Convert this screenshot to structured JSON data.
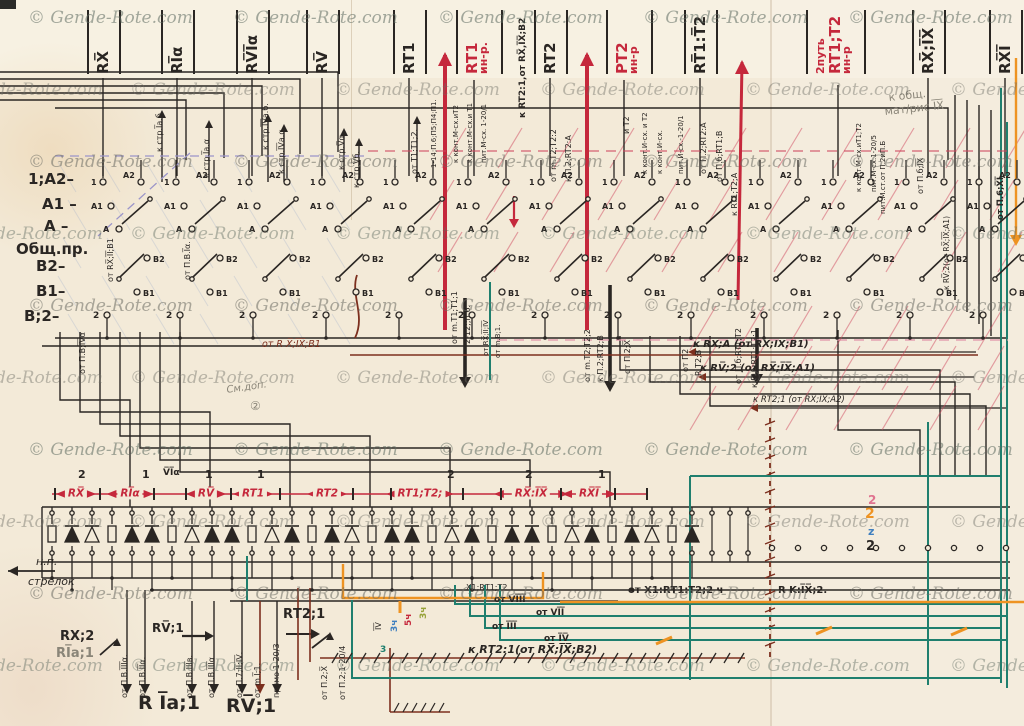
{
  "watermark": {
    "text": "© Gende-Rote.com"
  },
  "colors": {
    "ink": "#2a2623",
    "red": "#c5283c",
    "maroon": "#7c2f1e",
    "teal": "#1f7f6e",
    "orange": "#ee9322",
    "blue": "#3f7fbf",
    "pencil": "#8a8578",
    "pink": "#e0738f",
    "green": "#97a239",
    "lavender": "#9b95c9",
    "paper": "#f3ead8"
  },
  "top_labels": [
    {
      "name": "strip-rx",
      "lines": [
        "RX̅"
      ],
      "main": 0,
      "x": 103,
      "color": "ink"
    },
    {
      "name": "strip-ria",
      "lines": [
        "RI̅α"
      ],
      "main": 0,
      "x": 177,
      "color": "ink"
    },
    {
      "name": "strip-rvia",
      "lines": [
        "RV̅I̅α"
      ],
      "main": 0,
      "x": 252,
      "color": "ink"
    },
    {
      "name": "strip-rv",
      "lines": [
        "RV̅"
      ],
      "main": 0,
      "x": 322,
      "color": "ink"
    },
    {
      "name": "strip-rt1",
      "lines": [
        "RT1"
      ],
      "main": 0,
      "x": 409,
      "color": "ink"
    },
    {
      "name": "strip-rt1-inr",
      "lines": [
        "RT1",
        "ин-р."
      ],
      "main": 0,
      "x": 472,
      "color": "red"
    },
    {
      "name": "strip-rt2",
      "lines": [
        "RT2"
      ],
      "main": 0,
      "x": 550,
      "color": "ink"
    },
    {
      "name": "strip-pt2-inr",
      "lines": [
        "PT2",
        "ин-р"
      ],
      "main": 0,
      "x": 622,
      "color": "red"
    },
    {
      "name": "strip-rt1t2",
      "lines": [
        "RT̅1:T̅2"
      ],
      "main": 0,
      "x": 700,
      "color": "ink"
    },
    {
      "name": "strip-2put",
      "lines": [
        "2путь",
        "RT1;T2",
        "ин-р"
      ],
      "main": 1,
      "x": 822,
      "color": "red"
    },
    {
      "name": "strip-rxix",
      "lines": [
        "RX̅;I̅X̅"
      ],
      "main": 0,
      "x": 928,
      "color": "ink"
    },
    {
      "name": "strip-rxi",
      "lines": [
        "RX̅I̅"
      ],
      "main": 0,
      "x": 1005,
      "color": "ink"
    }
  ],
  "left_labels": [
    {
      "name": "row-1a2",
      "t": "1;A2–",
      "x": 28,
      "y": 172
    },
    {
      "name": "row-a1",
      "t": "A1 –",
      "x": 42,
      "y": 197
    },
    {
      "name": "row-a",
      "t": "A –",
      "x": 44,
      "y": 219
    },
    {
      "name": "row-obsh",
      "t": "Общ.пр.",
      "x": 16,
      "y": 242
    },
    {
      "name": "row-b2",
      "t": "B2–",
      "x": 36,
      "y": 259
    },
    {
      "name": "row-b1",
      "t": "B1–",
      "x": 36,
      "y": 284
    },
    {
      "name": "row-b2b",
      "t": "B;2–",
      "x": 24,
      "y": 309
    }
  ],
  "rail": {
    "labels": [
      {
        "t": "RX̅",
        "x": 76
      },
      {
        "t": "RI̅α",
        "x": 130
      },
      {
        "t": "RV̅",
        "x": 206
      },
      {
        "t": "RT1",
        "x": 253
      },
      {
        "t": "RT2",
        "x": 327
      },
      {
        "t": "RT1;T2;",
        "x": 420
      },
      {
        "t": "RX̅:I̅X̅",
        "x": 531
      },
      {
        "t": "RX̅I̅",
        "x": 589
      }
    ],
    "numbers": [
      {
        "t": "2",
        "x": 78
      },
      {
        "t": "1",
        "x": 142
      },
      {
        "t": "V̅I̅α",
        "x": 163,
        "small": true
      },
      {
        "t": "1",
        "x": 205
      },
      {
        "t": "1",
        "x": 257
      },
      {
        "t": "2",
        "x": 447
      },
      {
        "t": "2",
        "x": 525
      },
      {
        "t": "1",
        "x": 598
      }
    ],
    "ticks": [
      54,
      99,
      153,
      185,
      230,
      279,
      352,
      390,
      462,
      500,
      560,
      614,
      646
    ]
  },
  "contact": {
    "centers": [
      135,
      208,
      281,
      354,
      427,
      500,
      573,
      646,
      719,
      792,
      865,
      938,
      1011
    ],
    "terminals": {
      "t1": "1",
      "a2": "A2",
      "a1": "A1",
      "a": "A",
      "b2": "B2",
      "b1": "B1",
      "t2": "2"
    }
  },
  "diodes": {
    "pattern": [
      "R",
      "F",
      "O",
      "R",
      "F",
      "F",
      "R",
      "O",
      "F",
      "F",
      "R",
      "O",
      "F",
      "R",
      "F",
      "O",
      "R",
      "F",
      "F",
      "R",
      "O",
      "F",
      "R",
      "F",
      "F",
      "R",
      "O",
      "F",
      "R",
      "F",
      "O",
      "R",
      "F"
    ]
  },
  "labels": [
    {
      "n": "wire-k-str-1a-b",
      "t": "к стр.I̅a.б.",
      "x": 156,
      "y": 152,
      "r": -90
    },
    {
      "n": "wire-k-str-1a-a",
      "t": "к стр.I̅a.α",
      "x": 203,
      "y": 178,
      "r": -90
    },
    {
      "n": "wire-k-str-4a-b",
      "t": "к стр.I̅V̅a.б.",
      "x": 262,
      "y": 150,
      "r": -90
    },
    {
      "n": "wire-k-str-4a-a",
      "t": "к стр.I̅V̅a.α.",
      "x": 278,
      "y": 174,
      "r": -90
    },
    {
      "n": "wire-k-str-va",
      "t": "к стр.V̅α.",
      "x": 338,
      "y": 170,
      "r": -90
    },
    {
      "n": "wire-k-str-vb",
      "t": "к стр.V̅б.",
      "x": 353,
      "y": 188,
      "r": -90
    },
    {
      "n": "wire-ot-t1",
      "t": "от Т1;Т1;2.",
      "x": 411,
      "y": 174,
      "r": -90
    },
    {
      "n": "wire-114",
      "t": "1-14;П.6;П5;П4;П1.",
      "x": 431,
      "y": 168,
      "r": -90,
      "s": 7
    },
    {
      "n": "wire-kont-m-t2",
      "t": "к конт.М-сх.иТ2",
      "x": 453,
      "y": 163,
      "r": -90,
      "s": 7
    },
    {
      "n": "wire-kont-m-t1",
      "t": "к конт.М-сх.и Т1",
      "x": 467,
      "y": 163,
      "r": -90,
      "s": 7
    },
    {
      "n": "wire-pit-m",
      "t": "пит.М-сх. 1-20/1",
      "x": 481,
      "y": 163,
      "r": -90,
      "s": 7
    },
    {
      "n": "wire-krt21",
      "t": "к RT2:1,от RX̅,I̅X̅;B2",
      "x": 519,
      "y": 118,
      "r": -90,
      "s": 9,
      "b": 1
    },
    {
      "n": "wire-ot-mt2",
      "t": "от m.Т2;Т2:2",
      "x": 550,
      "y": 182,
      "r": -90
    },
    {
      "n": "wire-kp2-rt2a",
      "t": "к П.2;RT2:A",
      "x": 565,
      "y": 182,
      "r": -90
    },
    {
      "n": "wire-it2",
      "t": "и Т2",
      "x": 623,
      "y": 134,
      "r": -90
    },
    {
      "n": "wire-kont-i-t2",
      "t": "к конт.И-сх. и Т2",
      "x": 642,
      "y": 174,
      "r": -90,
      "s": 7
    },
    {
      "n": "wire-kont-i",
      "t": "к конт.И-сх.",
      "x": 657,
      "y": 174,
      "r": -90,
      "s": 7
    },
    {
      "n": "wire-pit-i",
      "t": "пит.И-сх.-1-20/1",
      "x": 678,
      "y": 174,
      "r": -90,
      "s": 7
    },
    {
      "n": "wire-otp2-rt2a",
      "t": "от П.2;RT2:A",
      "x": 700,
      "y": 174,
      "r": -90
    },
    {
      "n": "wire-otpb-rt1b",
      "t": "от П.б;RT1;B",
      "x": 716,
      "y": 182,
      "r": -90
    },
    {
      "n": "wire-krt1t2a",
      "t": "к RT1;Т2;A",
      "x": 731,
      "y": 216,
      "r": -90
    },
    {
      "n": "wire-kont-m-t1t2",
      "t": "к конт.М-сх.иТ1;Т2",
      "x": 856,
      "y": 192,
      "r": -90,
      "s": 7
    },
    {
      "n": "wire-pit-m5",
      "t": "пит.М-сх.1-20/5",
      "x": 871,
      "y": 192,
      "r": -90,
      "s": 7
    },
    {
      "n": "wire-pit-mst",
      "t": "пит.М.ст.от П.2иП.Б",
      "x": 880,
      "y": 214,
      "r": -90,
      "s": 7
    },
    {
      "n": "wire-otpb-ix",
      "t": "от П.б;I̅X̅",
      "x": 917,
      "y": 194,
      "r": -90
    },
    {
      "n": "wire-krv2",
      "t": "к RV̅;2(от RX̅;I̅X̅;A1)",
      "x": 943,
      "y": 290,
      "r": -90,
      "s": 7.5
    },
    {
      "n": "wire-otp6-xi",
      "t": "от П.6;X̅I̅",
      "x": 997,
      "y": 220,
      "r": -90,
      "s": 8.5,
      "b": 1
    },
    {
      "n": "wire-otpv-4a",
      "t": "от П.В;I̅V̅α",
      "x": 79,
      "y": 374,
      "r": -90
    },
    {
      "n": "wire-otrx-b1",
      "t": "от RX̅;I̅I̅;B1",
      "x": 107,
      "y": 282,
      "r": -90
    },
    {
      "n": "wire-otpv-1a",
      "t": "от П.В.I̅α.",
      "x": 184,
      "y": 280,
      "r": -90
    },
    {
      "n": "wire-ot-mt22",
      "t": "от m.Т2;Т2;2",
      "x": 584,
      "y": 382,
      "r": -90
    },
    {
      "n": "wire-kp2rt2b",
      "t": "к П.2;RT2;B",
      "x": 597,
      "y": 382,
      "r": -90
    },
    {
      "n": "wire-otp2x",
      "t": "от П.2;X̅",
      "x": 624,
      "y": 374,
      "r": -90
    },
    {
      "n": "wire-otp2",
      "t": "от П2",
      "x": 682,
      "y": 372,
      "r": -90
    },
    {
      "n": "wire-rt2b",
      "t": "R Т2;B",
      "x": 695,
      "y": 376,
      "r": -90
    },
    {
      "n": "wire-otpb-rt1t2",
      "t": "от П.б;RT1;Т2",
      "x": 735,
      "y": 384,
      "r": -90
    },
    {
      "n": "wire-kpb-rt1t21",
      "t": "к П.б;RT1;Т2;1",
      "x": 751,
      "y": 388,
      "r": -90
    },
    {
      "n": "wire-otmt1",
      "t": "от m.Т1;Т1;1",
      "x": 451,
      "y": 344,
      "r": -90
    },
    {
      "n": "wire-212",
      "t": "2-12;;п.6.",
      "x": 464,
      "y": 344,
      "r": -90
    },
    {
      "n": "wire-otrx24",
      "t": "от RX̅;I̅I̅;I̅V̅",
      "x": 483,
      "y": 356,
      "r": -90,
      "s": 7
    },
    {
      "n": "wire-otmv1",
      "t": "от m.В;1.",
      "x": 495,
      "y": 358,
      "r": -90,
      "s": 7
    },
    {
      "n": "bot-otpv3a-1",
      "t": "от П.В.I̅I̅I̅α.",
      "x": 121,
      "y": 698,
      "r": -90
    },
    {
      "n": "bot-otpv2a",
      "t": "от П.В.I̅I̅α.",
      "x": 139,
      "y": 698,
      "r": -90
    },
    {
      "n": "bot-otpv3v",
      "t": "от П.В.I̅I̅I̅в.",
      "x": 186,
      "y": 698,
      "r": -90
    },
    {
      "n": "bot-otpv3a-2",
      "t": "от П.В.I̅I̅I̅α",
      "x": 208,
      "y": 698,
      "r": -90
    },
    {
      "n": "bot-otp7",
      "t": "от П.7;I̅I̅;I̅V̅.",
      "x": 236,
      "y": 698,
      "r": -90
    },
    {
      "n": "bot-otm11",
      "t": "от m.I̅;1.",
      "x": 254,
      "y": 698,
      "r": -90
    },
    {
      "n": "bot-pryamo",
      "t": "прямо 1-20/3",
      "x": 273,
      "y": 698,
      "r": -90
    },
    {
      "n": "bot-otp2x",
      "t": "от П.2;X̅",
      "x": 321,
      "y": 700,
      "r": -90
    },
    {
      "n": "bot-otp2-1204",
      "t": "от П.2;1-20/4",
      "x": 339,
      "y": 700,
      "r": -90
    },
    {
      "n": "line-otrxb1",
      "t": "от R X̅;I̅X̅;B1",
      "x": 262,
      "y": 340,
      "s": 9.5,
      "c": "maroon",
      "i": 1
    },
    {
      "n": "line-krxa",
      "t": "к RX̅;A (от RX̅;I̅X̅;B1)",
      "x": 693,
      "y": 340,
      "s": 10,
      "i": 1,
      "b": 1
    },
    {
      "n": "line-krv2",
      "t": "к RV̅;2 (от RX̅;I̅X̅;A1)",
      "x": 700,
      "y": 364,
      "s": 10,
      "i": 1,
      "b": 1
    },
    {
      "n": "line-krt21a2",
      "t": "к RТ2;1 (от RX̅;I̅X̅;A2)",
      "x": 753,
      "y": 396,
      "s": 8.5,
      "i": 1
    },
    {
      "n": "line-krt21b2",
      "t": "к RТ2:1(от RX̅;I̅X̅;B2)",
      "x": 468,
      "y": 644,
      "s": 11,
      "i": 1,
      "b": 1
    },
    {
      "n": "line-otx1",
      "t": "от X1:RТ1:Т2;2 ч",
      "x": 628,
      "y": 586,
      "s": 10,
      "b": 1
    },
    {
      "n": "line-rkix2",
      "t": "R K:I̅X̅;2.",
      "x": 778,
      "y": 586,
      "s": 10,
      "b": 1
    },
    {
      "n": "bus-ot8",
      "t": "от VI̅I̅I̅",
      "x": 494,
      "y": 596,
      "s": 9,
      "b": 1
    },
    {
      "n": "bus-ot7",
      "t": "от VI̅I̅",
      "x": 536,
      "y": 609,
      "s": 9,
      "b": 1
    },
    {
      "n": "bus-ot3",
      "t": "от I̅I̅I̅",
      "x": 492,
      "y": 623,
      "s": 9,
      "b": 1
    },
    {
      "n": "bus-ot4",
      "t": "от I̅V̅",
      "x": 544,
      "y": 635,
      "s": 9,
      "b": 1
    },
    {
      "n": "note-np",
      "t": "н.п.",
      "x": 36,
      "y": 556,
      "s": 11,
      "i": 1
    },
    {
      "n": "note-strelok",
      "t": "стрелок",
      "x": 28,
      "y": 576,
      "s": 11,
      "i": 1
    },
    {
      "n": "note-rx2",
      "t": "RX;2",
      "x": 60,
      "y": 630,
      "s": 13,
      "b": 1
    },
    {
      "n": "note-r1a1-small",
      "t": "RI̅a;1",
      "x": 56,
      "y": 647,
      "s": 13,
      "b": 1,
      "c": "pencil"
    },
    {
      "n": "note-rv1-small",
      "t": "RV̅;1",
      "x": 152,
      "y": 622,
      "s": 12,
      "b": 1
    },
    {
      "n": "note-rt21",
      "t": "RТ2;1",
      "x": 283,
      "y": 608,
      "s": 13,
      "b": 1
    },
    {
      "n": "note-r1a1",
      "t": "R I̅a;1",
      "x": 138,
      "y": 694,
      "s": 19,
      "b": 1
    },
    {
      "n": "note-rv1",
      "t": "RV̅;1",
      "x": 226,
      "y": 697,
      "s": 19,
      "b": 1
    },
    {
      "n": "note-kobsh",
      "t": "к общ.",
      "x": 888,
      "y": 92,
      "s": 11,
      "c": "pencil",
      "r": -6
    },
    {
      "n": "note-matris",
      "t": "мат/рис I̅X̅",
      "x": 884,
      "y": 106,
      "s": 11,
      "c": "pencil",
      "r": -6
    },
    {
      "n": "note-smdop",
      "t": "См.доп.",
      "x": 226,
      "y": 386,
      "s": 10,
      "c": "pencil",
      "i": 1,
      "r": -8
    },
    {
      "n": "note-sm2",
      "t": "②",
      "x": 250,
      "y": 400,
      "s": 12,
      "c": "pencil"
    },
    {
      "n": "note-x1rt1",
      "t": "X1;RТ1;Т2",
      "x": 466,
      "y": 584,
      "s": 8
    },
    {
      "n": "num-2-pink",
      "t": "2",
      "x": 868,
      "y": 494,
      "s": 12,
      "c": "pink",
      "b": 1
    },
    {
      "n": "num-2-orange",
      "t": "2",
      "x": 865,
      "y": 507,
      "s": 14,
      "c": "orange",
      "b": 1
    },
    {
      "n": "num-2-blue",
      "t": "z",
      "x": 868,
      "y": 526,
      "s": 11,
      "c": "blue",
      "b": 1
    },
    {
      "n": "num-2-ink",
      "t": "2",
      "x": 866,
      "y": 540,
      "s": 13,
      "b": 1
    },
    {
      "n": "num-3ch-blue",
      "t": "3ч",
      "x": 391,
      "y": 632,
      "r": -90,
      "s": 9,
      "c": "blue",
      "b": 1
    },
    {
      "n": "num-5ch-red",
      "t": "5ч",
      "x": 405,
      "y": 626,
      "r": -90,
      "s": 9,
      "c": "red",
      "b": 1
    },
    {
      "n": "num-3ch-green",
      "t": "3ч",
      "x": 420,
      "y": 619,
      "r": -90,
      "s": 9,
      "c": "green",
      "b": 1
    },
    {
      "n": "num-4v",
      "t": "I̅V̅",
      "x": 375,
      "y": 630,
      "r": -90,
      "s": 8
    },
    {
      "n": "num-3-teal",
      "t": "3",
      "x": 380,
      "y": 646,
      "s": 9,
      "c": "teal",
      "b": 1
    }
  ]
}
